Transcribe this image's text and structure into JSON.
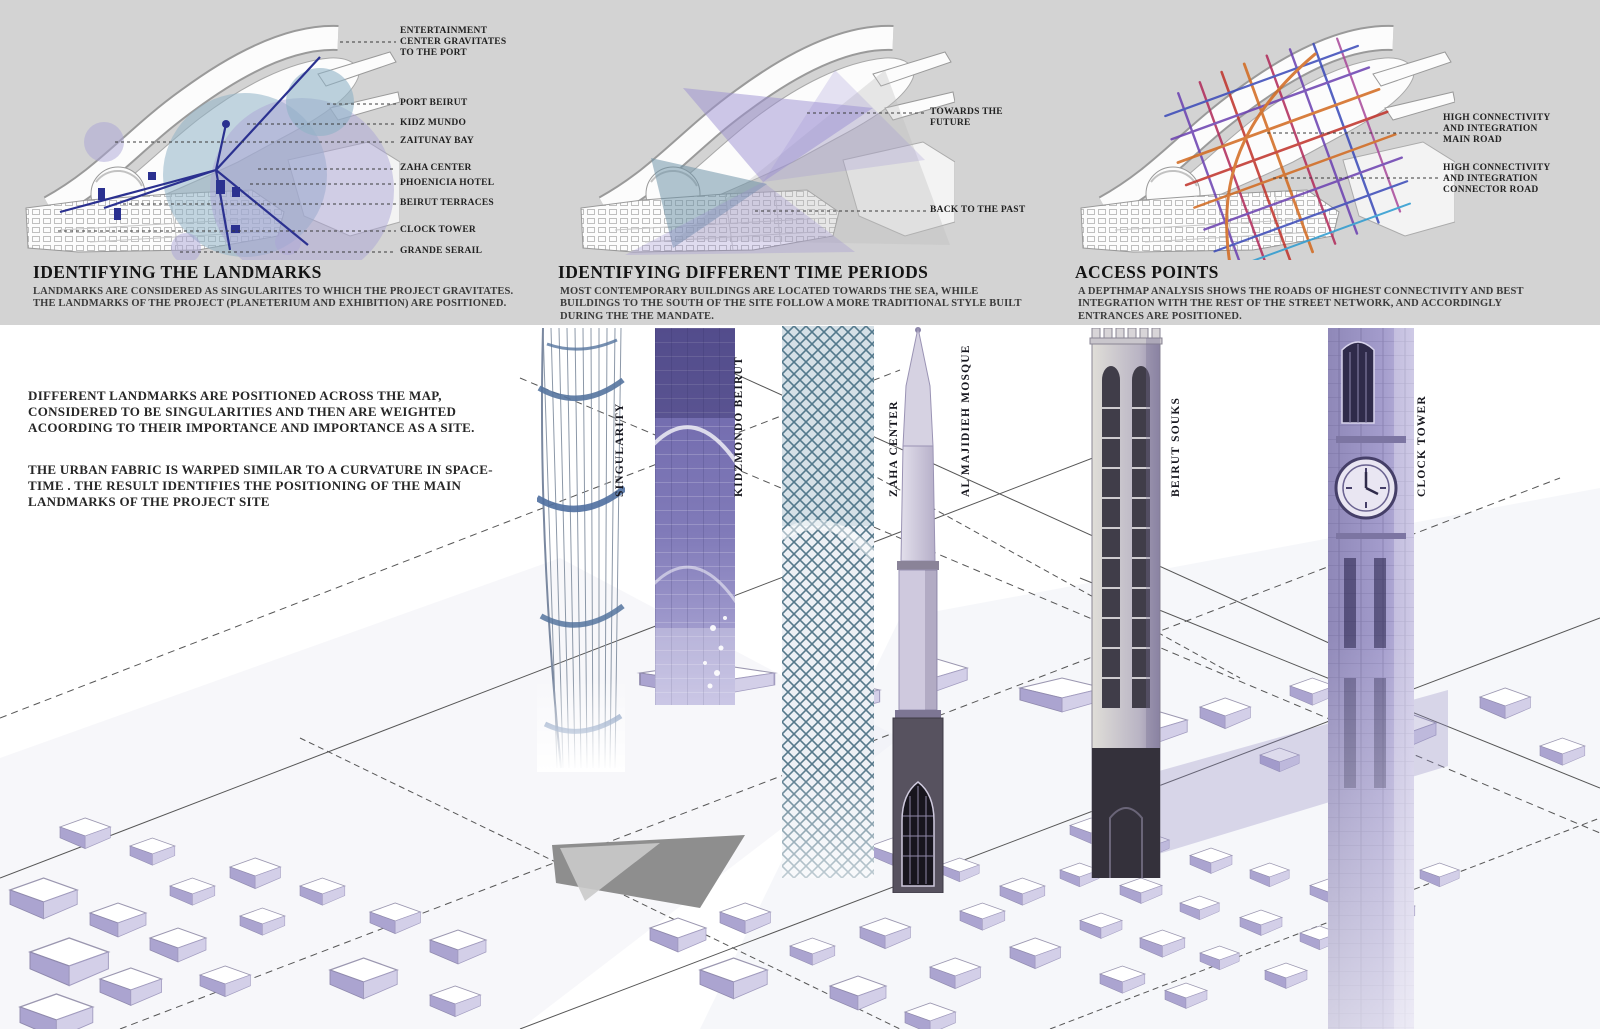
{
  "panels": {
    "landmarks": {
      "heading": "IDENTIFYING THE LANDMARKS",
      "body": "LANDMARKS ARE CONSIDERED AS SINGULARITES TO WHICH THE PROJECT GRAVITATES. THE LANDMARKS OF THE PROJECT (PLANETERIUM AND EXHIBITION) ARE POSITIONED.",
      "labels": [
        "ENTERTAINMENT CENTER GRAVITATES TO THE PORT",
        "PORT BEIRUT",
        "KIDZ MUNDO",
        "ZAITUNAY BAY",
        "ZAHA CENTER",
        "PHOENICIA HOTEL",
        "BEIRUT TERRACES",
        "CLOCK TOWER",
        "GRANDE SERAIL"
      ]
    },
    "time_periods": {
      "heading": "IDENTIFYING DIFFERENT TIME PERIODS",
      "body": "MOST CONTEMPORARY BUILDINGS ARE LOCATED TOWARDS THE SEA, WHILE BUILDINGS TO THE SOUTH OF THE SITE FOLLOW A MORE TRADITIONAL STYLE BUILT DURING THE THE MANDATE.",
      "labels": [
        "TOWARDS THE FUTURE",
        "BACK TO THE PAST"
      ]
    },
    "access_points": {
      "heading": "ACCESS POINTS",
      "body": "A DEPTHMAP ANALYSIS SHOWS THE ROADS OF HIGHEST CONNECTIVITY AND BEST INTEGRATION WITH THE REST OF THE STREET NETWORK, AND ACCORDINGLY ENTRANCES ARE POSITIONED.",
      "labels": [
        "HIGH CONNECTIVITY AND INTEGRATION MAIN ROAD",
        "HIGH CONNECTIVITY AND INTEGRATION CONNECTOR ROAD"
      ]
    }
  },
  "model": {
    "paragraphs": [
      "DIFFERENT LANDMARKS ARE POSITIONED ACROSS THE MAP, CONSIDERED TO BE SINGULARITIES AND THEN ARE WEIGHTED ACOORDING TO THEIR IMPORTANCE AND IMPORTANCE AS A SITE.",
      "THE URBAN FABRIC IS WARPED SIMILAR TO A CURVATURE IN SPACE-TIME . THE RESULT IDENTIFIES THE POSITIONING OF THE MAIN LANDMARKS OF THE PROJECT SITE"
    ],
    "towers": [
      {
        "label": "SINGULARITY"
      },
      {
        "label": "KIDZMONDO BEIRUT"
      },
      {
        "label": "ZAHA CENTER"
      },
      {
        "label": "AL MAJIDIEH MOSQUE"
      },
      {
        "label": "BEIRUT SOUKS"
      },
      {
        "label": "CLOCK TOWER"
      }
    ]
  },
  "colors": {
    "band_background": "#d3d3d3",
    "landmark_navy": "#2b3190",
    "gravity_lavender": "#aaa4d6",
    "gravity_teal": "#8fb3c6",
    "future_purple": "#9c90d2",
    "past_teal": "#6f94a8",
    "model_shadow_lavender": "#aba4d0",
    "road_main_orange": "#d2691e",
    "road_connector_blue": "#3848b8"
  }
}
